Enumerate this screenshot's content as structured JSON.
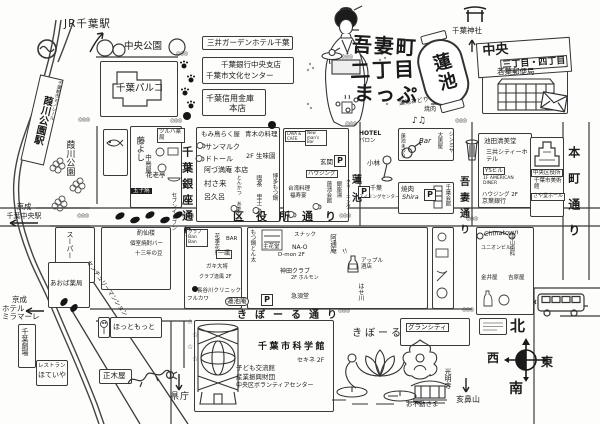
{
  "title": {
    "l1": "吾妻町",
    "l2": "二丁目",
    "l3": "まっぷ",
    "lantern": "蓮池",
    "note1": "蓮池おどり",
    "note2": "焼肉"
  },
  "compass": {
    "n": "北",
    "s": "南",
    "e": "東",
    "w": "西"
  },
  "decor": {
    "crossing": "◎◎◎",
    "star": "☆",
    "notes": "♪♫",
    "p": "P",
    "ex": "!!"
  },
  "top": {
    "jr": "JR千葉駅",
    "chuo_park": "中央公園",
    "parco": "千葉パルコ",
    "mitsui": "三井ガーデンホテル千葉",
    "chiba_bank": "千葉銀行中央支店",
    "bunka": "千葉市文化センター",
    "shinkin": "千葉信用金庫",
    "honten": "本店",
    "jinja": "千葉神社",
    "banner1": "中央",
    "banner2": "三丁目・四丁目",
    "post": "若葉郵便局"
  },
  "left": {
    "monorail": "千葉都市モノレール",
    "station": "葭川公園駅",
    "park": "葭川公園",
    "keisei_chuo_l1": "京成",
    "keisei_chuo_l2": "千葉中央駅",
    "miramare_l1": "京成",
    "miramare_l2": "ホテル",
    "miramare_l3": "ミラマーレ",
    "super": "スーパー",
    "aoba": "あおば薬局",
    "gekijo": "千葉劇場",
    "restaurant": "レストラン",
    "hoteiya": "ほていや"
  },
  "streets": {
    "ginza": "千葉銀座通り",
    "kuyakusho": "区役所通り",
    "kibore": "きぼーる通り",
    "azuma": "吾妻通り",
    "honcho": "本町通り",
    "hasuike": "蓮池"
  },
  "ginza_west": {
    "fujiyoshi": "藤よし",
    "tsuruha": "ツルハ薬局",
    "nakajimaya": "中島屋",
    "karotei": "花老亭",
    "tamago": "玉子焼",
    "seven": "セブンイレブン"
  },
  "ginza_east": {
    "momidori": "もみ鳥らく屋",
    "aoki": "青木の料理",
    "sanmaruku": "サンマルク",
    "dotor": "ドトール",
    "seimien": "2F 生味園",
    "azumaan": "阿づ満庵 本店",
    "murasaki": "村さ来",
    "rokuro": "呂久呂",
    "tonkatsu": "とんかつ あさくら",
    "kissa": "喫茶 里土",
    "motsunabe": "博多もつ鍋"
  },
  "block_c": {
    "lava": "LAVA & CAFE",
    "newmans": "New man's Bar",
    "genkan": "玄関",
    "housing": "ハウジング",
    "taiwan": "台湾料理",
    "fukuju": "福寿宴",
    "kaikan": "蓮池会館",
    "ginzayu": "銀座湯",
    "cleaning": "クリーニング"
  },
  "hasuike_area": {
    "hotel": "HOTEL",
    "hotel2": "パロン",
    "kobayashi": "小林",
    "swim1": "千葉",
    "swim2": "スイミングセンター",
    "matsuri": "蓮池まつり",
    "bar": "Bar",
    "daikoku": "大黒屋",
    "shinmiya": "シンミヤ",
    "yakiniku": "焼肉",
    "shira": "Shira",
    "chiba_kaikan": "千葉会館"
  },
  "east": {
    "ikeda": "池田清美堂",
    "sankyo": "三共シティーホテル",
    "ys": "YSビル",
    "diner": "1F AMERICAN DINER",
    "housing2": "ハウジング 2F",
    "keiyo": "京葉銀行",
    "ward": "中央区役所",
    "museum": "千葉市美術館",
    "sayado": "さや堂ホール"
  },
  "center_south": {
    "banban": "クラブ Ban Ban",
    "kaki": "花季花夢",
    "bar2": "BAR",
    "ichifu": "一颯",
    "gaki": "ガキ大将",
    "ippu": "クラブ逸風 2F",
    "hasegawa": "長谷川クリニック",
    "furukawa": "フルカワ",
    "hasuikean": "蓮池庵",
    "motsu": "もつ鍋とん太",
    "shukado": "主花堂",
    "snack": "スナック",
    "nao": "NA-O",
    "dmon": "D-mon 2F",
    "kanda": "神田クラブ",
    "horumon": "2F ホルモン",
    "kyusudo": "急須堂",
    "atsuan": "阿通庵",
    "sake": "アップル酒店",
    "hasekawa": "はせ川"
  },
  "south": {
    "science": "千葉市科学館",
    "kodomo": "子ども交流館",
    "sangyo": "産業振興財団",
    "volunteer": "中央区ボランティアセンター",
    "sekine": "セキネ 2F",
    "kiboru": "きぼーる",
    "grancity": "グランシティ",
    "fudo": "お不動さま",
    "komyoji": "光明寺",
    "inohana": "亥鼻山",
    "kencho": "県庁",
    "masakiya": "正木屋",
    "hotto": "ほっともっと",
    "mansion": "センチュリーマンション",
    "shaku1": "酌仙楼",
    "shaku2": "個室焼酎バー",
    "shaku3": "十三年の豆"
  },
  "southeast": {
    "hirayama": "平山歯科",
    "yoshiwara": "吉原屋",
    "union": "ユニオンビル",
    "kanai": "金井屋",
    "chinatown": "Chinatown"
  }
}
